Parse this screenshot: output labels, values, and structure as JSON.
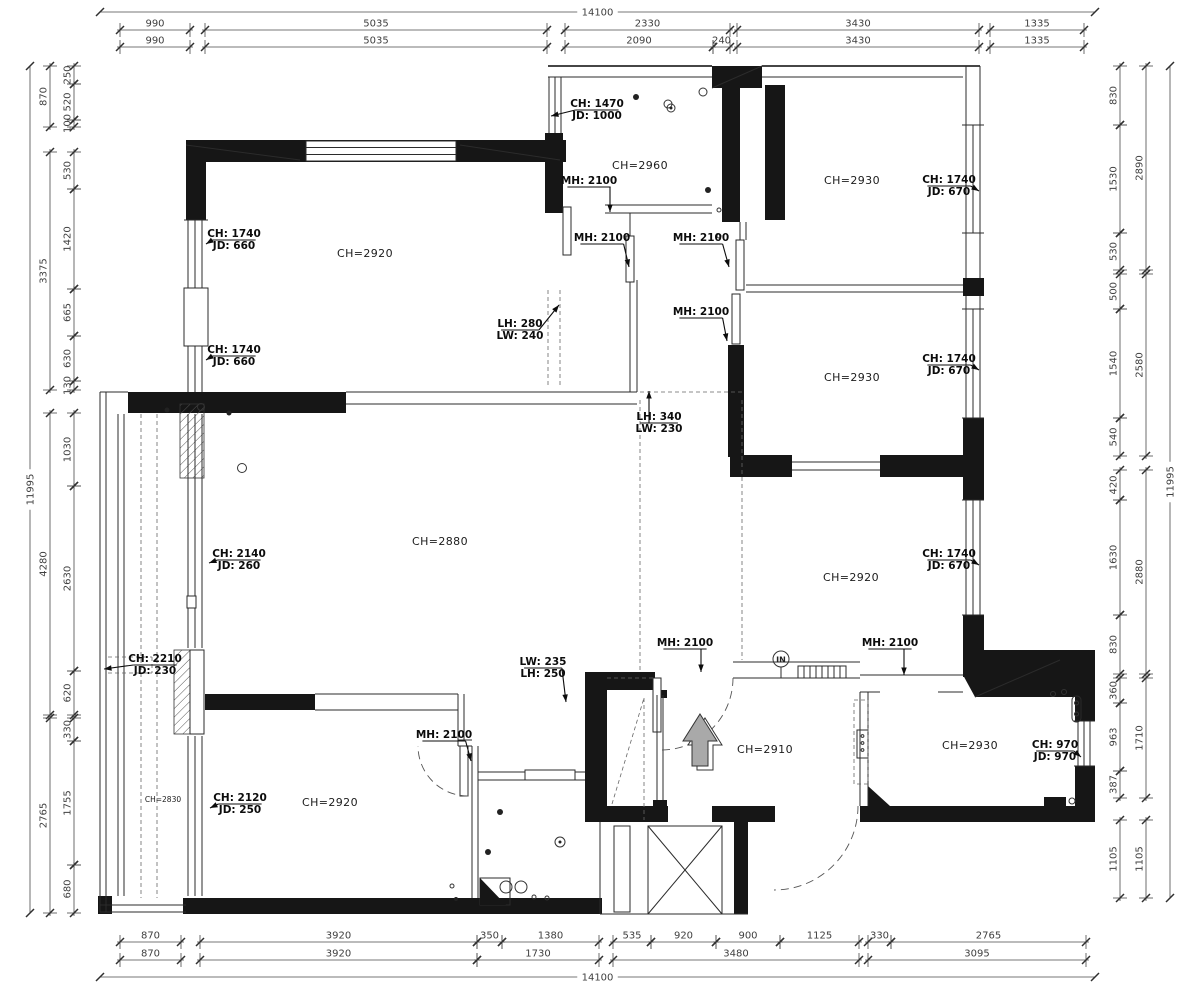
{
  "symbols": {
    "entry_label": "IN"
  },
  "dims": {
    "top_overall": {
      "v": "14100",
      "a": 100,
      "b": 1095,
      "y": 12
    },
    "bottom_overall": {
      "v": "14100",
      "a": 100,
      "b": 1095,
      "y": 977
    },
    "left_overall": {
      "v": "11995",
      "a": 66,
      "b": 913,
      "x": 30
    },
    "right_overall": {
      "v": "11995",
      "a": 66,
      "b": 898,
      "x": 1170
    },
    "top_rows": [
      {
        "y": 30,
        "segs": [
          {
            "v": "990",
            "a": 120,
            "b": 190
          },
          {
            "v": "5035",
            "a": 205,
            "b": 547
          },
          {
            "v": "2330",
            "a": 565,
            "b": 730
          },
          {
            "v": "3430",
            "a": 737,
            "b": 979
          },
          {
            "v": "1335",
            "a": 990,
            "b": 1084
          }
        ]
      },
      {
        "y": 47,
        "segs": [
          {
            "v": "990",
            "a": 120,
            "b": 190
          },
          {
            "v": "5035",
            "a": 205,
            "b": 547
          },
          {
            "v": "2090",
            "a": 565,
            "b": 713
          },
          {
            "v": "240",
            "a": 713,
            "b": 730
          },
          {
            "v": "3430",
            "a": 737,
            "b": 979
          },
          {
            "v": "1335",
            "a": 990,
            "b": 1084
          }
        ]
      }
    ],
    "bottom_rows": [
      {
        "y": 942,
        "segs": [
          {
            "v": "870",
            "a": 120,
            "b": 181
          },
          {
            "v": "3920",
            "a": 200,
            "b": 477
          },
          {
            "v": "350",
            "a": 477,
            "b": 502
          },
          {
            "v": "1380",
            "a": 502,
            "b": 599
          },
          {
            "v": "535",
            "a": 613,
            "b": 651
          },
          {
            "v": "920",
            "a": 651,
            "b": 716
          },
          {
            "v": "900",
            "a": 716,
            "b": 780
          },
          {
            "v": "1125",
            "a": 780,
            "b": 859
          },
          {
            "v": "330",
            "a": 868,
            "b": 891
          },
          {
            "v": "2765",
            "a": 891,
            "b": 1086
          }
        ]
      },
      {
        "y": 960,
        "segs": [
          {
            "v": "870",
            "a": 120,
            "b": 181
          },
          {
            "v": "3920",
            "a": 200,
            "b": 477
          },
          {
            "v": "1730",
            "a": 477,
            "b": 599
          },
          {
            "v": "3480",
            "a": 613,
            "b": 859
          },
          {
            "v": "3095",
            "a": 868,
            "b": 1086
          }
        ]
      }
    ],
    "left_cols": [
      {
        "x": 50,
        "segs": [
          {
            "v": "870",
            "a": 66,
            "b": 127
          },
          {
            "v": "3375",
            "a": 152,
            "b": 390
          },
          {
            "v": "4280",
            "a": 413,
            "b": 715
          },
          {
            "v": "2765",
            "a": 718,
            "b": 913
          }
        ]
      },
      {
        "x": 74,
        "segs": [
          {
            "v": "250",
            "a": 66,
            "b": 84
          },
          {
            "v": "520",
            "a": 84,
            "b": 120
          },
          {
            "v": "100",
            "a": 120,
            "b": 127
          },
          {
            "v": "530",
            "a": 152,
            "b": 189
          },
          {
            "v": "1420",
            "a": 189,
            "b": 289
          },
          {
            "v": "665",
            "a": 289,
            "b": 336
          },
          {
            "v": "630",
            "a": 336,
            "b": 381
          },
          {
            "v": "130",
            "a": 381,
            "b": 390
          },
          {
            "v": "1030",
            "a": 413,
            "b": 486
          },
          {
            "v": "2630",
            "a": 486,
            "b": 671
          },
          {
            "v": "620",
            "a": 671,
            "b": 715
          },
          {
            "v": "330",
            "a": 718,
            "b": 741
          },
          {
            "v": "1755",
            "a": 741,
            "b": 865
          },
          {
            "v": "680",
            "a": 865,
            "b": 913
          }
        ]
      }
    ],
    "right_cols": [
      {
        "x": 1120,
        "segs": [
          {
            "v": "830",
            "a": 66,
            "b": 125
          },
          {
            "v": "1530",
            "a": 125,
            "b": 233
          },
          {
            "v": "530",
            "a": 233,
            "b": 270
          },
          {
            "v": "500",
            "a": 274,
            "b": 309
          },
          {
            "v": "1540",
            "a": 309,
            "b": 418
          },
          {
            "v": "540",
            "a": 418,
            "b": 456
          },
          {
            "v": "420",
            "a": 470,
            "b": 500
          },
          {
            "v": "1630",
            "a": 500,
            "b": 615
          },
          {
            "v": "830",
            "a": 615,
            "b": 674
          },
          {
            "v": "360",
            "a": 678,
            "b": 703
          },
          {
            "v": "963",
            "a": 703,
            "b": 771
          },
          {
            "v": "387",
            "a": 771,
            "b": 798
          },
          {
            "v": "1105",
            "a": 820,
            "b": 898
          }
        ]
      },
      {
        "x": 1146,
        "segs": [
          {
            "v": "2890",
            "a": 66,
            "b": 270
          },
          {
            "v": "2580",
            "a": 274,
            "b": 456
          },
          {
            "v": "2880",
            "a": 470,
            "b": 674
          },
          {
            "v": "1710",
            "a": 678,
            "b": 798
          },
          {
            "v": "1105",
            "a": 820,
            "b": 898
          }
        ]
      }
    ]
  },
  "room_labels": [
    {
      "t": "CH=2960",
      "x": 640,
      "y": 169
    },
    {
      "t": "CH=2930",
      "x": 852,
      "y": 184
    },
    {
      "t": "CH=2920",
      "x": 365,
      "y": 257
    },
    {
      "t": "CH=2930",
      "x": 852,
      "y": 381
    },
    {
      "t": "CH=2880",
      "x": 440,
      "y": 545
    },
    {
      "t": "CH=2920",
      "x": 851,
      "y": 581
    },
    {
      "t": "CH=2910",
      "x": 765,
      "y": 753
    },
    {
      "t": "CH=2930",
      "x": 970,
      "y": 749
    },
    {
      "t": "CH=2920",
      "x": 330,
      "y": 806
    },
    {
      "t": "CH=2830",
      "x": 163,
      "y": 802,
      "s": 1
    }
  ],
  "leader_labels": [
    {
      "n": "window-label",
      "l1": "CH: 1470",
      "l2": "JD: 1000",
      "x": 597,
      "y": 107,
      "tx": 551,
      "ty": 116
    },
    {
      "n": "door-label",
      "l1": "MH: 2100",
      "x": 589,
      "y": 184,
      "tx": 610,
      "ty": 212
    },
    {
      "n": "door-label",
      "l1": "MH: 2100",
      "x": 602,
      "y": 241,
      "tx": 629,
      "ty": 267
    },
    {
      "n": "door-label",
      "l1": "MH: 2100",
      "x": 701,
      "y": 241,
      "tx": 729,
      "ty": 267
    },
    {
      "n": "door-label",
      "l1": "MH: 2100",
      "x": 701,
      "y": 315,
      "tx": 727,
      "ty": 341
    },
    {
      "n": "window-label",
      "l1": "CH: 1740",
      "l2": "JD: 670",
      "x": 949,
      "y": 183,
      "tx": 979,
      "ty": 191
    },
    {
      "n": "window-label",
      "l1": "CH: 1740",
      "l2": "JD: 660",
      "x": 234,
      "y": 237,
      "tx": 206,
      "ty": 244
    },
    {
      "n": "window-label",
      "l1": "CH: 1740",
      "l2": "JD: 660",
      "x": 234,
      "y": 353,
      "tx": 206,
      "ty": 360
    },
    {
      "n": "beam-label",
      "l1": "LH: 280",
      "l2": "LW: 240",
      "x": 520,
      "y": 327,
      "tx": 559,
      "ty": 305
    },
    {
      "n": "beam-label",
      "l1": "LH: 340",
      "l2": "LW: 230",
      "x": 659,
      "y": 420,
      "tx": 649,
      "ty": 391
    },
    {
      "n": "window-label",
      "l1": "CH: 1740",
      "l2": "JD: 670",
      "x": 949,
      "y": 362,
      "tx": 979,
      "ty": 370
    },
    {
      "n": "window-label",
      "l1": "CH: 2140",
      "l2": "JD: 260",
      "x": 239,
      "y": 557,
      "tx": 209,
      "ty": 563
    },
    {
      "n": "window-label",
      "l1": "CH: 2210",
      "l2": "JD: 230",
      "x": 155,
      "y": 662,
      "tx": 104,
      "ty": 669
    },
    {
      "n": "window-label",
      "l1": "CH: 1740",
      "l2": "JD: 670",
      "x": 949,
      "y": 557,
      "tx": 979,
      "ty": 565
    },
    {
      "n": "door-label",
      "l1": "MH: 2100",
      "x": 685,
      "y": 646,
      "tx": 701,
      "ty": 672
    },
    {
      "n": "door-label",
      "l1": "MH: 2100",
      "x": 890,
      "y": 646,
      "tx": 904,
      "ty": 675
    },
    {
      "n": "beam-label",
      "l1": "LW: 235",
      "l2": "LH: 250",
      "x": 543,
      "y": 665,
      "tx": 566,
      "ty": 702
    },
    {
      "n": "door-label",
      "l1": "MH: 2100",
      "x": 444,
      "y": 738,
      "tx": 471,
      "ty": 761
    },
    {
      "n": "window-label",
      "l1": "CH: 970",
      "l2": "JD: 970",
      "x": 1055,
      "y": 748,
      "tx": 1081,
      "ty": 757
    },
    {
      "n": "window-label",
      "l1": "CH: 2120",
      "l2": "JD: 250",
      "x": 240,
      "y": 801,
      "tx": 210,
      "ty": 808
    }
  ]
}
